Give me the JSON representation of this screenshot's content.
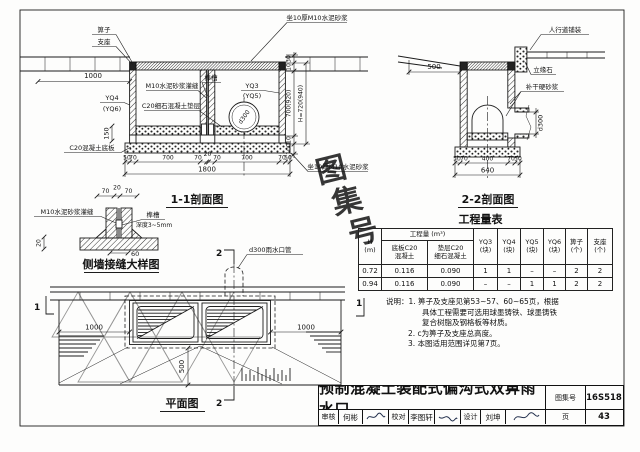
{
  "watermark": {
    "char1": "图",
    "char2": "集",
    "char3": "号"
  },
  "s11": {
    "title": "1-1剖面图",
    "grate": "箅子",
    "support": "支座",
    "mortar_top": "坐10厚M10水泥砂浆",
    "mortar_bottom": "坐10厚M10水泥砂浆",
    "dim_left": "1000",
    "grout": "M10水泥砂浆灌缝",
    "tenon": "榫槽",
    "wall_right": "YQ3",
    "wall_right_alt": "(YQ5)",
    "wall_left": "YQ4",
    "wall_left_alt": "(YQ6)",
    "cushion": "C20细石混凝土垫层",
    "slab": "C20混凝土底板",
    "pipe": "d300",
    "dim_150": "150",
    "dims_bottom": [
      "50",
      "70",
      "700",
      "70",
      "20",
      "70",
      "700",
      "70",
      "50"
    ],
    "dim_total": "1800",
    "dims_right": [
      "30",
      "10",
      "700(920)",
      "10",
      "100"
    ],
    "dim_height": "H=720(940)",
    "dims_joint": [
      "70",
      "20",
      "70"
    ]
  },
  "s22": {
    "title": "2-2剖面图",
    "sidewalk": "人行道铺装",
    "curb": "立缘石",
    "mortar": "补干硬砂浆",
    "dim_500": "500",
    "dim_pipe": "d300",
    "dims_bottom": [
      "50",
      "70",
      "400",
      "70",
      "50"
    ],
    "dim_total": "640"
  },
  "joint": {
    "title": "侧墙接缝大样图",
    "grout": "M10水泥砂浆灌缝",
    "tenon": "榫槽",
    "tenon_depth": "深度3~5mm",
    "dim_20": "20",
    "dim_60": "60"
  },
  "plan": {
    "title": "平面图",
    "pipe_label": "d300雨水口管",
    "dim_left": "1000",
    "dim_right": "1000",
    "dim_500": "500",
    "marker1": "1",
    "marker2": "2"
  },
  "qty": {
    "title": "工程量表",
    "h": "H",
    "h_unit": "(m)",
    "group": "工程量 (m³)",
    "slab1": "底板C20",
    "slab2": "混凝土",
    "cush1": "垫层C20",
    "cush2": "细石混凝土",
    "c_yq3": "YQ3",
    "c_yq4": "YQ4",
    "c_yq5": "YQ5",
    "c_yq6": "YQ6",
    "c_grate": "箅子",
    "c_support": "支座",
    "u_block": "(块)",
    "u_piece": "(个)",
    "rows": [
      [
        "0.72",
        "0.116",
        "0.090",
        "1",
        "1",
        "–",
        "–",
        "2",
        "2"
      ],
      [
        "0.94",
        "0.116",
        "0.090",
        "–",
        "–",
        "1",
        "1",
        "2",
        "2"
      ]
    ]
  },
  "notes": {
    "l1": "说明：1. 箅子及支座见第53~57、60~65页，根据",
    "l2": "具体工程需要可选用球墨铸铁、球墨铸铁",
    "l3": "复合树脂及钢格板等材质。",
    "l4": "2. c为箅子及支座总高度。",
    "l5": "3. 本图适用范围详见第7页。"
  },
  "tb": {
    "title": "预制混凝土装配式偏沟式双箅雨水口",
    "atlas_label": "图集号",
    "atlas_no": "16S518",
    "review_label": "审核",
    "reviewer": "何彬",
    "proof_label": "校对",
    "proofer": "李图轩",
    "design_label": "设计",
    "designer": "刘坤",
    "page_label": "页",
    "page_no": "43"
  }
}
